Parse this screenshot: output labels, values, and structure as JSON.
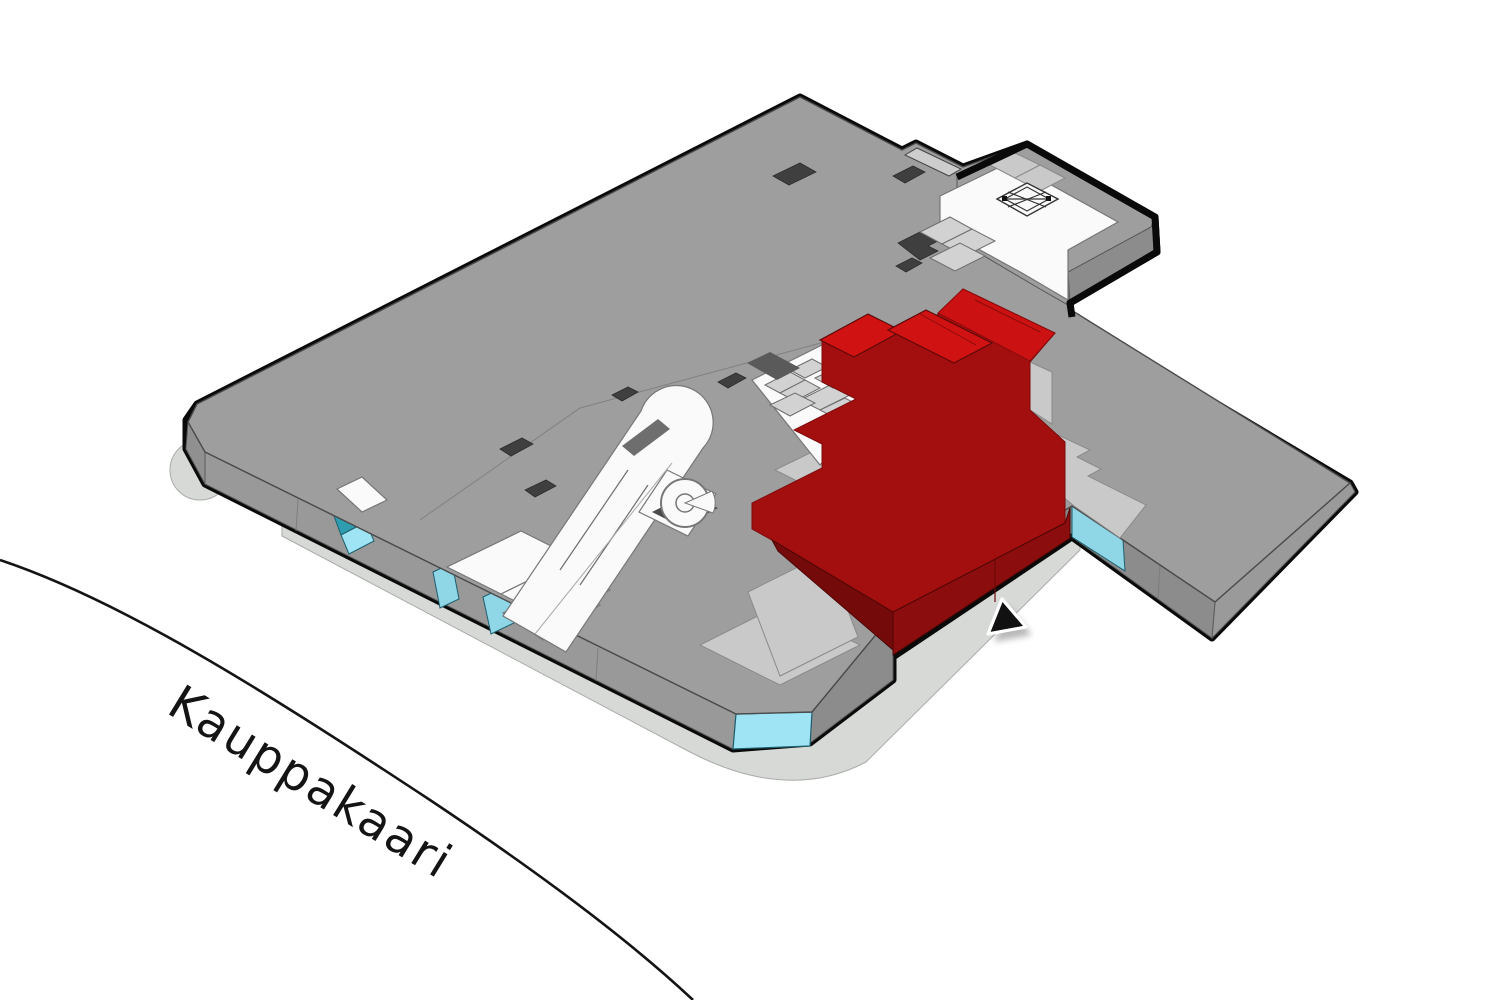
{
  "street": {
    "label": "Kauppakaari"
  },
  "map": {
    "type": "isometric-mall-floorplan",
    "selected_unit": {
      "highlighted": true,
      "status": "selected"
    }
  },
  "icons": {
    "cursor": "pointer-arrow",
    "elevator": "box-with-x",
    "spiral_stair": "spiral-ring",
    "escalator": "diagonal-band",
    "entrance": "cyan-glass-panel"
  },
  "colors": {
    "background": "#FFFFFF",
    "outline": "#0A0A0A",
    "roof": "#9E9E9E",
    "wall_generic": "#8C8C8C",
    "wall_right": "#9A9A9A",
    "wall_sw": "#999999",
    "roof_light": "#C9C9C9",
    "room_white": "#FAFAFA",
    "shadow": "#D6D9D5",
    "unit_top": "#A30F0F",
    "unit_top_bright": "#D01212",
    "unit_wall_right": "#8B0D0D",
    "unit_wall_left": "#740A0A",
    "entrance_light": "#9EE4F4",
    "entrance_mid": "#8FD6E6",
    "entrance_dark": "#2F9DB0"
  }
}
